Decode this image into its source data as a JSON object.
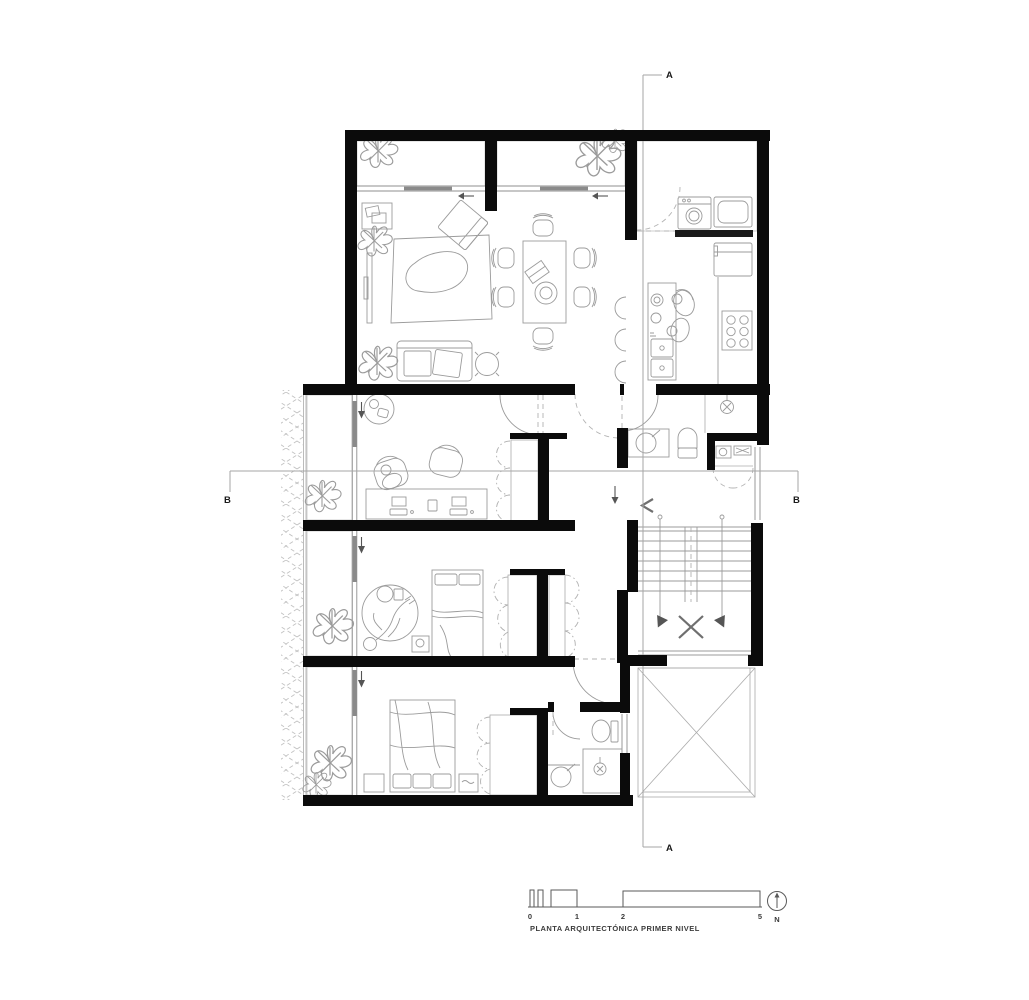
{
  "plan": {
    "title": "PLANTA ARQUITECTÓNICA PRIMER NIVEL",
    "section_a_top": "A",
    "section_a_bottom": "A",
    "section_b_left": "B",
    "section_b_right": "B",
    "north": "N",
    "scale_ticks": [
      "0",
      "1",
      "2",
      "5"
    ],
    "colors": {
      "background": "#ffffff",
      "wall": "#0b0b0b",
      "furniture_line": "#9b9b9b",
      "brick_line": "#cfcfcf",
      "section_line": "#a6a6a6",
      "glass_leaf": "#8a8a8a"
    }
  }
}
